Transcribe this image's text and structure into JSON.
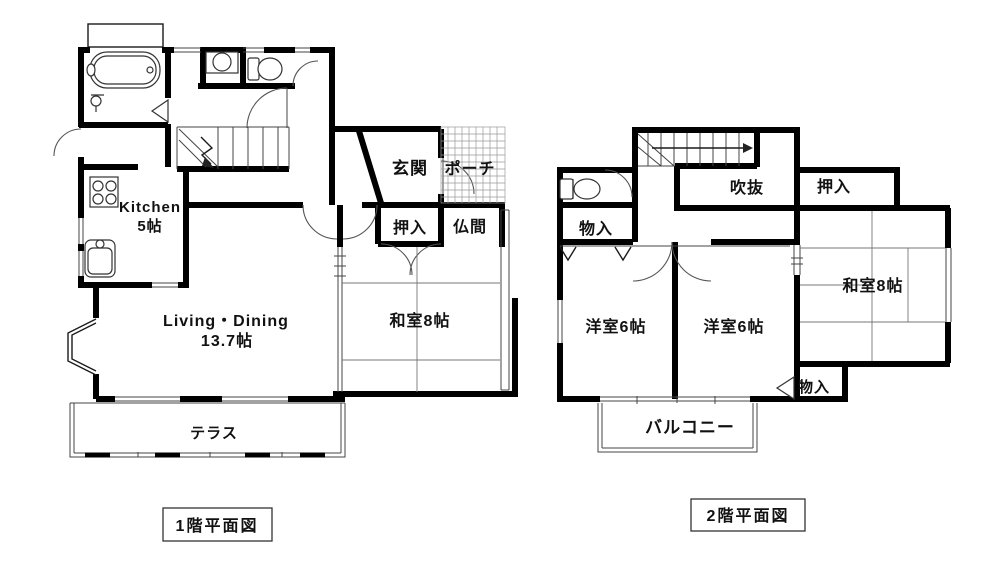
{
  "page": {
    "background": "#ffffff",
    "line_color": "#000000",
    "type": "floor-plan"
  },
  "floor1": {
    "caption": "1階平面図",
    "rooms": {
      "kitchen_name": "Kitchen",
      "kitchen_size": "5帖",
      "living_name": "Living・Dining",
      "living_size": "13.7帖",
      "washitsu": "和室8帖",
      "genkan": "玄関",
      "porch": "ポーチ",
      "oshiire": "押入",
      "butsuma": "仏間",
      "terrace": "テラス"
    }
  },
  "floor2": {
    "caption": "2階平面図",
    "rooms": {
      "fukinuke": "吹抜",
      "oshiire": "押入",
      "mononyu_upper": "物入",
      "yoshitsu_left": "洋室6帖",
      "yoshitsu_right": "洋室6帖",
      "washitsu": "和室8帖",
      "mononyu_lower": "物入",
      "balcony": "バルコニー"
    }
  }
}
